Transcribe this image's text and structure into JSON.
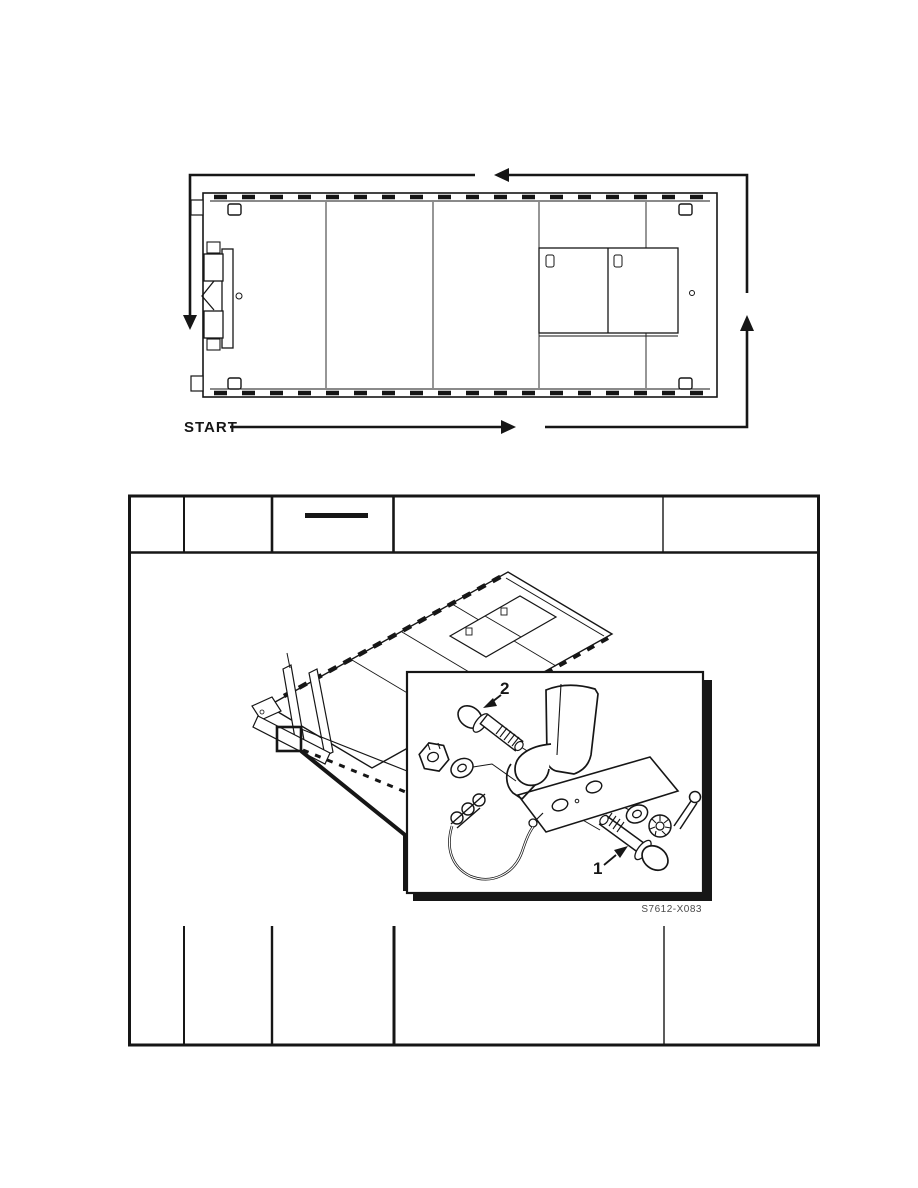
{
  "page": {
    "type": "scanned-technical-manual-page",
    "background": "#ffffff",
    "ink_color": "#161616",
    "caption_color": "#4a4a4a"
  },
  "walkaround_diagram": {
    "description": "trailer plan view with counterclockwise walk-around inspection path arrows",
    "start_label": "START"
  },
  "inspection_table": {
    "column_count": 5,
    "header_cells": [
      "",
      "",
      "",
      "",
      ""
    ],
    "header_blank_underline_column": 3
  },
  "figure": {
    "description": "trailer isometric view with exploded hardware detail inset (bolts, washers, castellated nuts, cotter pin with lanyard, bracket)",
    "callouts": [
      {
        "label": "1"
      },
      {
        "label": "2"
      }
    ],
    "figure_number": "S7612-X083"
  }
}
